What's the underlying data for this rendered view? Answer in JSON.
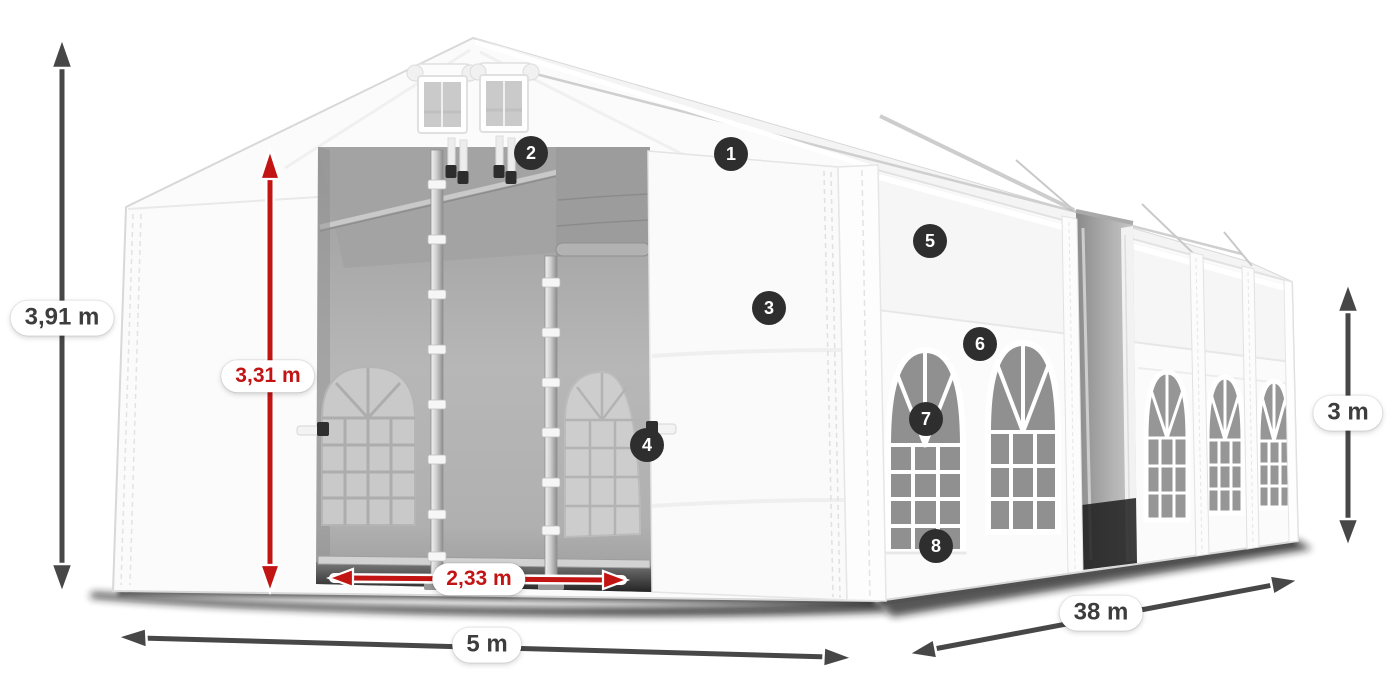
{
  "diagram": {
    "subject": "White marquee party tent shown in 3D with dimension arrows and numbered feature callouts",
    "background_color": "#ffffff"
  },
  "dimensions": {
    "total_height": {
      "label": "3,91 m",
      "style": "dark",
      "orientation": "vertical-left"
    },
    "door_height": {
      "label": "3,31 m",
      "style": "red",
      "orientation": "vertical-entrance"
    },
    "door_width": {
      "label": "2,33 m",
      "style": "red",
      "orientation": "horizontal-entrance"
    },
    "width": {
      "label": "5 m",
      "style": "dark",
      "orientation": "horizontal-front"
    },
    "length": {
      "label": "38 m",
      "style": "dark",
      "orientation": "diagonal-side"
    },
    "side_height": {
      "label": "3 m",
      "style": "dark",
      "orientation": "vertical-right"
    }
  },
  "callouts": {
    "items": [
      {
        "number": "1"
      },
      {
        "number": "2"
      },
      {
        "number": "3"
      },
      {
        "number": "4"
      },
      {
        "number": "5"
      },
      {
        "number": "6"
      },
      {
        "number": "7"
      },
      {
        "number": "8"
      }
    ]
  },
  "colors": {
    "dimension_red": "#c31414",
    "dimension_dark": "#474747",
    "callout_background": "#2e2e2e",
    "callout_text": "#ffffff",
    "label_background": "#ffffff",
    "label_text_dark": "#3d3d3d"
  }
}
